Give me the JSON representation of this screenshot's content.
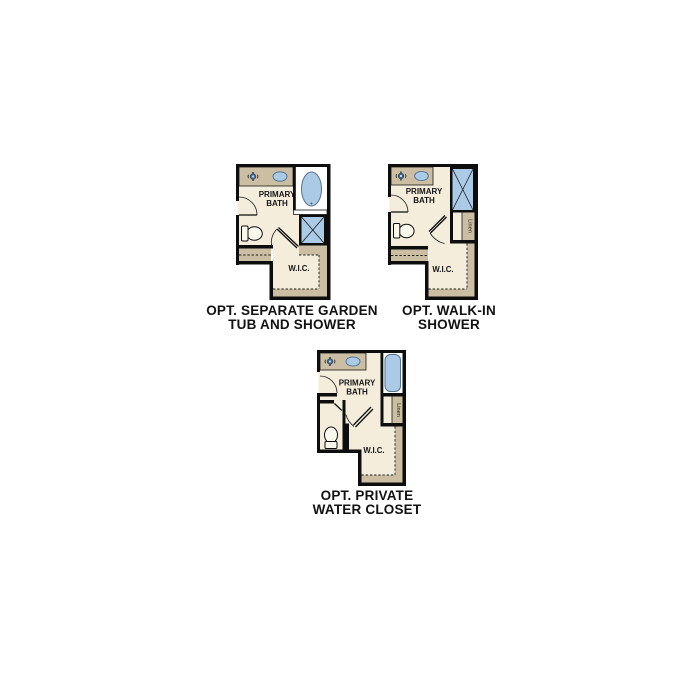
{
  "page": {
    "background_color": "#ffffff"
  },
  "colors": {
    "wall": "#0d0d0d",
    "floor_cream": "#f4eddb",
    "counter_tan": "#cbbea2",
    "fixture_blue": "#aacae6",
    "faucet_blue_dark": "#3f6590",
    "caption_text": "#121212"
  },
  "figures": [
    {
      "id": "opt-separate-garden-tub-and-shower",
      "caption": {
        "line1": "OPT. SEPARATE GARDEN",
        "line2": "TUB AND SHOWER"
      },
      "labels": {
        "room_line1": "PRIMARY",
        "room_line2": "BATH",
        "closet": "W.I.C."
      }
    },
    {
      "id": "opt-walk-in-shower",
      "caption": {
        "line1": "OPT. WALK-IN",
        "line2": "SHOWER"
      },
      "labels": {
        "room_line1": "PRIMARY",
        "room_line2": "BATH",
        "closet": "W.I.C.",
        "linen": "Linen"
      }
    },
    {
      "id": "opt-private-water-closet",
      "caption": {
        "line1": "OPT. PRIVATE",
        "line2": "WATER CLOSET"
      },
      "labels": {
        "room_line1": "PRIMARY",
        "room_line2": "BATH",
        "closet": "W.I.C.",
        "linen": "Linen"
      }
    }
  ]
}
